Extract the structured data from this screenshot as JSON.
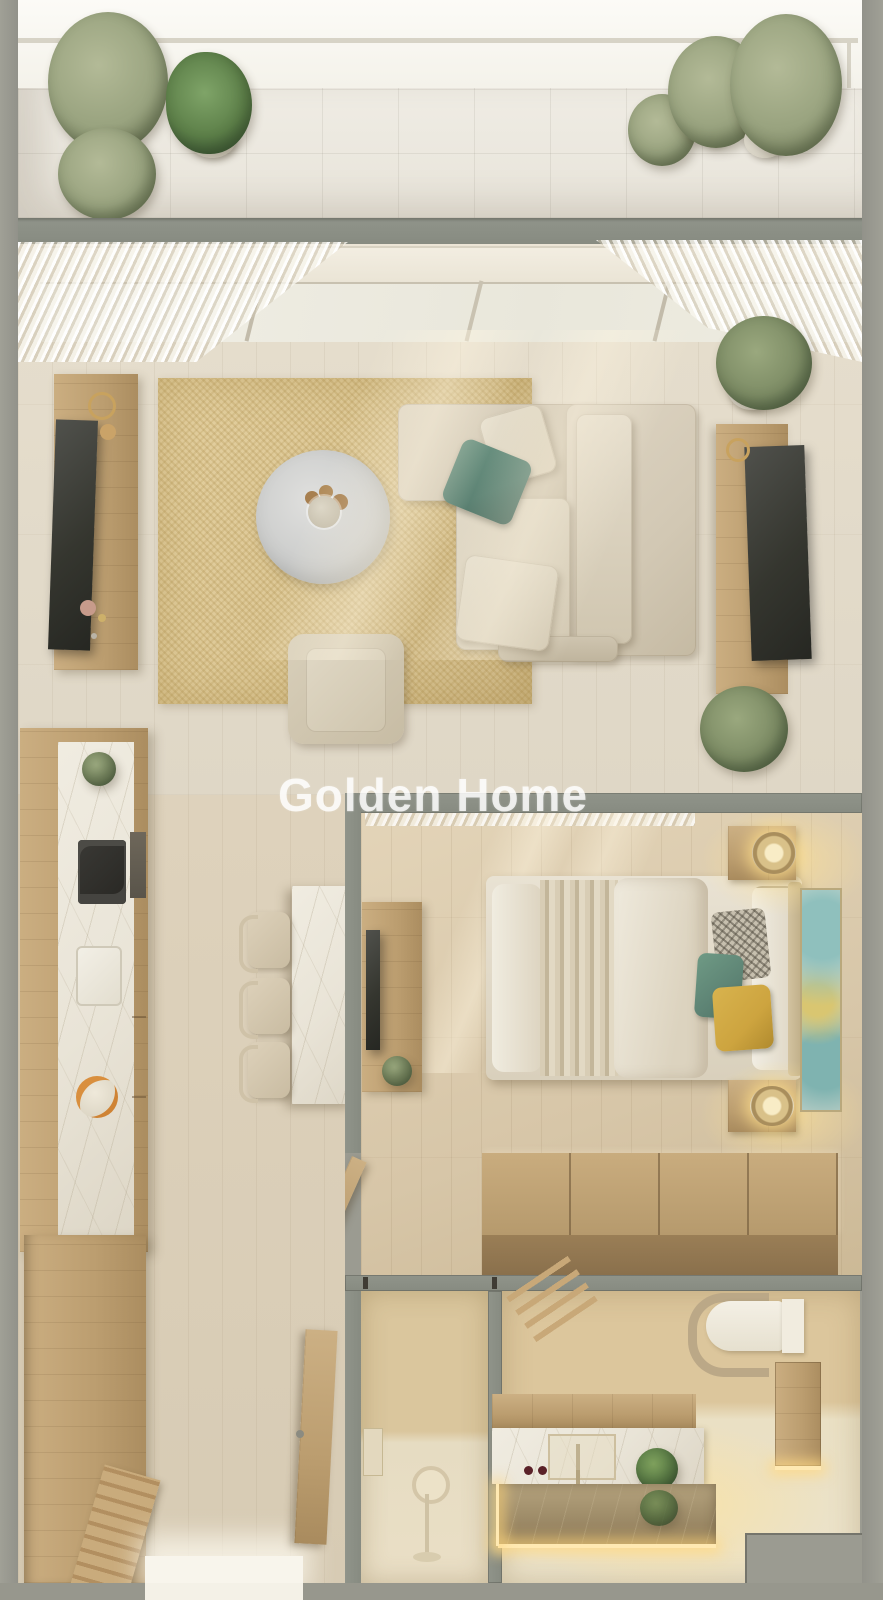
{
  "watermark": {
    "text": "Golden Home"
  },
  "palette": {
    "exterior_wall": "#9b9b91",
    "interior_wall": "#90948a",
    "terrace_tile": "#e8e4da",
    "living_floor": "#dfd7c6",
    "bedroom_floor": "#d7c6a8",
    "rug": "#dcc795",
    "sofa_fabric": "#d2c8b4",
    "accent_teal": "#5d8374",
    "accent_yellow": "#cda43f",
    "wood": "#bb9d6f",
    "marble": "#e9e4d7",
    "tv_screen": "#35362f",
    "plant_green": "#7d8c65",
    "bathroom_glow": "#f5e3ae"
  },
  "rooms": [
    {
      "id": "terrace",
      "furniture": [
        "glass-railing",
        "tile-floor",
        "potted-plants"
      ]
    },
    {
      "id": "living-room",
      "furniture": [
        "sheer-curtains",
        "sliding-window",
        "jute-rug",
        "round-coffee-table",
        "armchair",
        "l-shaped-sofa",
        "tv-sideboard-left",
        "tv-console-right",
        "potted-plants"
      ]
    },
    {
      "id": "kitchen",
      "furniture": [
        "counter-with-cooktop",
        "sink",
        "fruit-bowl",
        "island-table",
        "three-stools"
      ]
    },
    {
      "id": "bedroom",
      "furniture": [
        "double-bed",
        "nightstands-with-lamps",
        "tv-console",
        "wall-art",
        "storage-chest",
        "door"
      ]
    },
    {
      "id": "hallway",
      "furniture": [
        "drawer-dresser",
        "entry-bench",
        "entry-door"
      ]
    },
    {
      "id": "shower-room",
      "furniture": [
        "hand-shower",
        "wall-shelf"
      ]
    },
    {
      "id": "bathroom",
      "furniture": [
        "toilet",
        "towel-ladder",
        "vanity-with-sink",
        "mirror-reflection",
        "side-cabinet",
        "plant"
      ]
    }
  ]
}
